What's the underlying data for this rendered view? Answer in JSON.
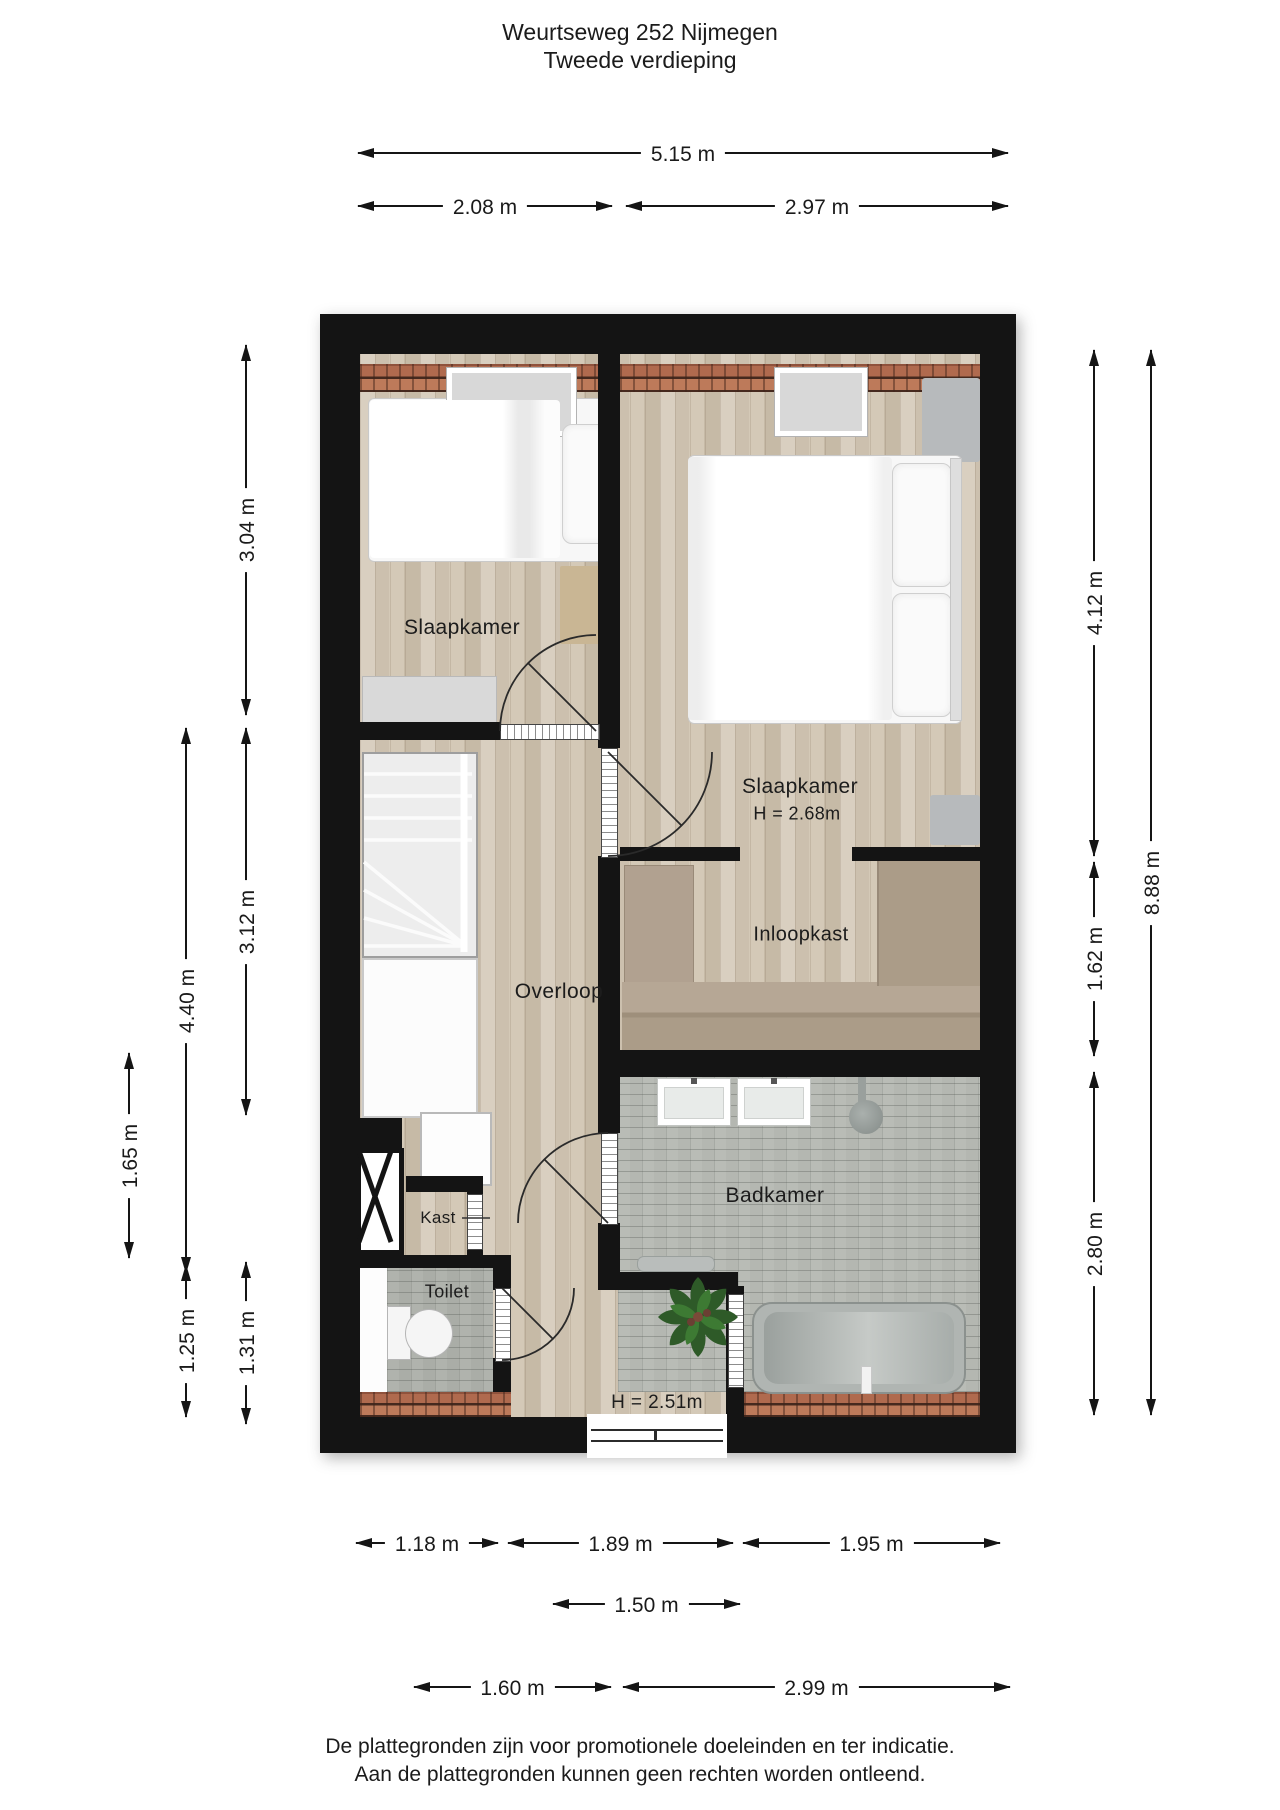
{
  "title": {
    "line1": "Weurtseweg 252 Nijmegen",
    "line2": "Tweede verdieping"
  },
  "footer": {
    "line1": "De plattegronden zijn voor promotionele doeleinden en ter indicatie.",
    "line2": "Aan de plattegronden kunnen geen rechten worden ontleend."
  },
  "plan": {
    "room_labels": [
      {
        "id": "slaapkamer-left",
        "text": "Slaapkamer",
        "x": 462,
        "y": 628,
        "size": 21
      },
      {
        "id": "slaapkamer-right",
        "text": "Slaapkamer",
        "x": 800,
        "y": 787,
        "size": 21
      },
      {
        "id": "slaapkamer-right-height",
        "text": "H = 2.68m",
        "x": 797,
        "y": 814,
        "size": 18
      },
      {
        "id": "overloop",
        "text": "Overloop",
        "x": 559,
        "y": 992,
        "size": 21
      },
      {
        "id": "inloopkast",
        "text": "Inloopkast",
        "x": 801,
        "y": 935,
        "size": 20
      },
      {
        "id": "badkamer",
        "text": "Badkamer",
        "x": 775,
        "y": 1196,
        "size": 21
      },
      {
        "id": "kast",
        "text": "Kast",
        "x": 438,
        "y": 1218,
        "size": 17
      },
      {
        "id": "toilet",
        "text": "Toilet",
        "x": 447,
        "y": 1292,
        "size": 18
      },
      {
        "id": "ceiling-height",
        "text": "H = 2.51m",
        "x": 657,
        "y": 1403,
        "size": 19
      }
    ],
    "dimensions": [
      {
        "id": "width-total",
        "label": "5.15 m",
        "orient": "h",
        "x1": 358,
        "x2": 1008,
        "y": 152
      },
      {
        "id": "width-left",
        "label": "2.08 m",
        "orient": "h",
        "x1": 358,
        "x2": 612,
        "y": 205
      },
      {
        "id": "width-right",
        "label": "2.97 m",
        "orient": "h",
        "x1": 626,
        "x2": 1008,
        "y": 205
      },
      {
        "id": "left-304",
        "label": "3.04 m",
        "orient": "v",
        "y1": 345,
        "y2": 715,
        "x": 245
      },
      {
        "id": "left-312",
        "label": "3.12 m",
        "orient": "v",
        "y1": 728,
        "y2": 1115,
        "x": 245
      },
      {
        "id": "left-440",
        "label": "4.40 m",
        "orient": "v",
        "y1": 728,
        "y2": 1273,
        "x": 185
      },
      {
        "id": "left-165",
        "label": "1.65 m",
        "orient": "v",
        "y1": 1053,
        "y2": 1258,
        "x": 128
      },
      {
        "id": "left-125",
        "label": "1.25 m",
        "orient": "v",
        "y1": 1265,
        "y2": 1417,
        "x": 185
      },
      {
        "id": "left-131",
        "label": "1.31 m",
        "orient": "v",
        "y1": 1262,
        "y2": 1424,
        "x": 245
      },
      {
        "id": "right-412",
        "label": "4.12 m",
        "orient": "v",
        "y1": 350,
        "y2": 856,
        "x": 1093
      },
      {
        "id": "right-162",
        "label": "1.62 m",
        "orient": "v",
        "y1": 862,
        "y2": 1056,
        "x": 1093
      },
      {
        "id": "right-280",
        "label": "2.80 m",
        "orient": "v",
        "y1": 1072,
        "y2": 1415,
        "x": 1093
      },
      {
        "id": "right-888",
        "label": "8.88 m",
        "orient": "v",
        "y1": 350,
        "y2": 1415,
        "x": 1150
      },
      {
        "id": "bottom-118",
        "label": "1.18 m",
        "orient": "h",
        "x1": 356,
        "x2": 498,
        "y": 1542
      },
      {
        "id": "bottom-189",
        "label": "1.89 m",
        "orient": "h",
        "x1": 508,
        "x2": 733,
        "y": 1542
      },
      {
        "id": "bottom-195",
        "label": "1.95 m",
        "orient": "h",
        "x1": 743,
        "x2": 1000,
        "y": 1542
      },
      {
        "id": "bottom-150",
        "label": "1.50 m",
        "orient": "h",
        "x1": 553,
        "x2": 740,
        "y": 1603
      },
      {
        "id": "bottom-160",
        "label": "1.60 m",
        "orient": "h",
        "x1": 414,
        "x2": 611,
        "y": 1686
      },
      {
        "id": "bottom-299",
        "label": "2.99 m",
        "orient": "h",
        "x1": 623,
        "x2": 1010,
        "y": 1686
      }
    ]
  }
}
